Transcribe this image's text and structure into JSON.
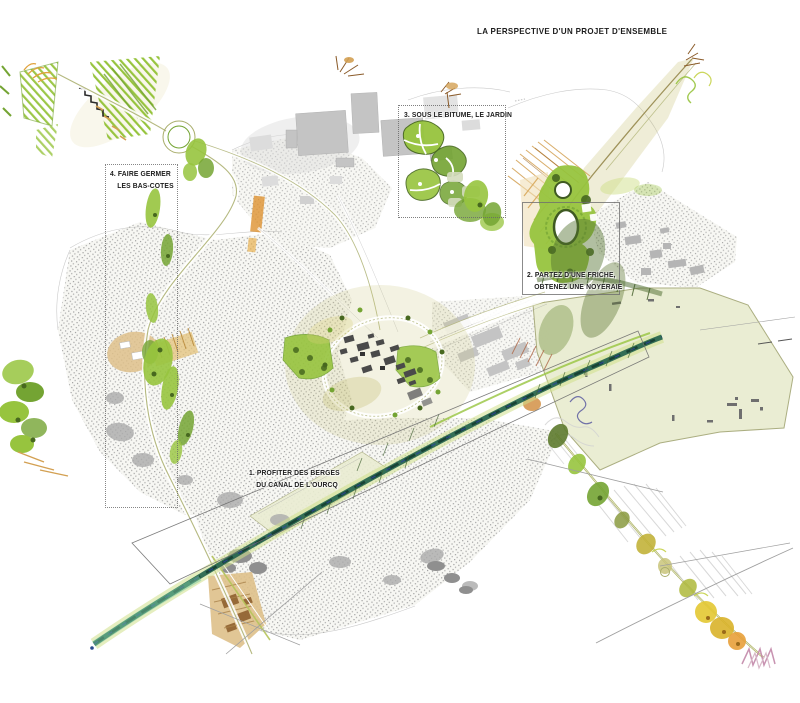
{
  "page": {
    "width": 800,
    "height": 703,
    "background": "#ffffff"
  },
  "title": "LA PERSPECTIVE D'UN PROJET D'ENSEMBLE",
  "annotations": {
    "a1": {
      "line1": "1. PROFITER DES BERGES",
      "line2": "DU CANAL DE L'OURCQ"
    },
    "a2": {
      "line1": "2. PARTEZ D'UNE FRICHE,",
      "line2": "OBTENEZ UNE NOYERAIE"
    },
    "a3": {
      "line1": "3. SOUS LE BITUME, LE JARDIN"
    },
    "a4": {
      "line1": "4. FAIRE GERMER",
      "line2": "LES BAS-COTES"
    }
  },
  "map": {
    "kind": "illustrated-masterplan-watercolor",
    "colors": {
      "ink": "#1c1c1c",
      "pencil": "#9f9f9f",
      "speckle": "#9e9e9e",
      "fabricBase": "#f7f7f3",
      "grayLight": "#dcdcdc",
      "gray": "#c4c4c4",
      "grayDark": "#8f8f8f",
      "townDark": "#4a4a4a",
      "greenBright": "#97c43e",
      "greenMid": "#74a433",
      "greenDark": "#47681f",
      "greenPale": "#cfe08a",
      "olive": "#a8ad6a",
      "khaki": "#c9c47a",
      "ochre": "#d3a052",
      "tan": "#dec08a",
      "brown": "#8a5a28",
      "orange": "#dd9130",
      "yellow": "#ddc52f",
      "pink": "#c287a9",
      "fieldFill": "#eaedd2",
      "fieldEdge": "#a9ac7d",
      "canalTeal": "#20604b",
      "canalDark": "#143c2f",
      "canalBlue": "#2a4a8e",
      "canalMint": "#7cc9a0",
      "fuzz": "#d2d2d2",
      "boxStroke": "#6e6e6e"
    }
  }
}
